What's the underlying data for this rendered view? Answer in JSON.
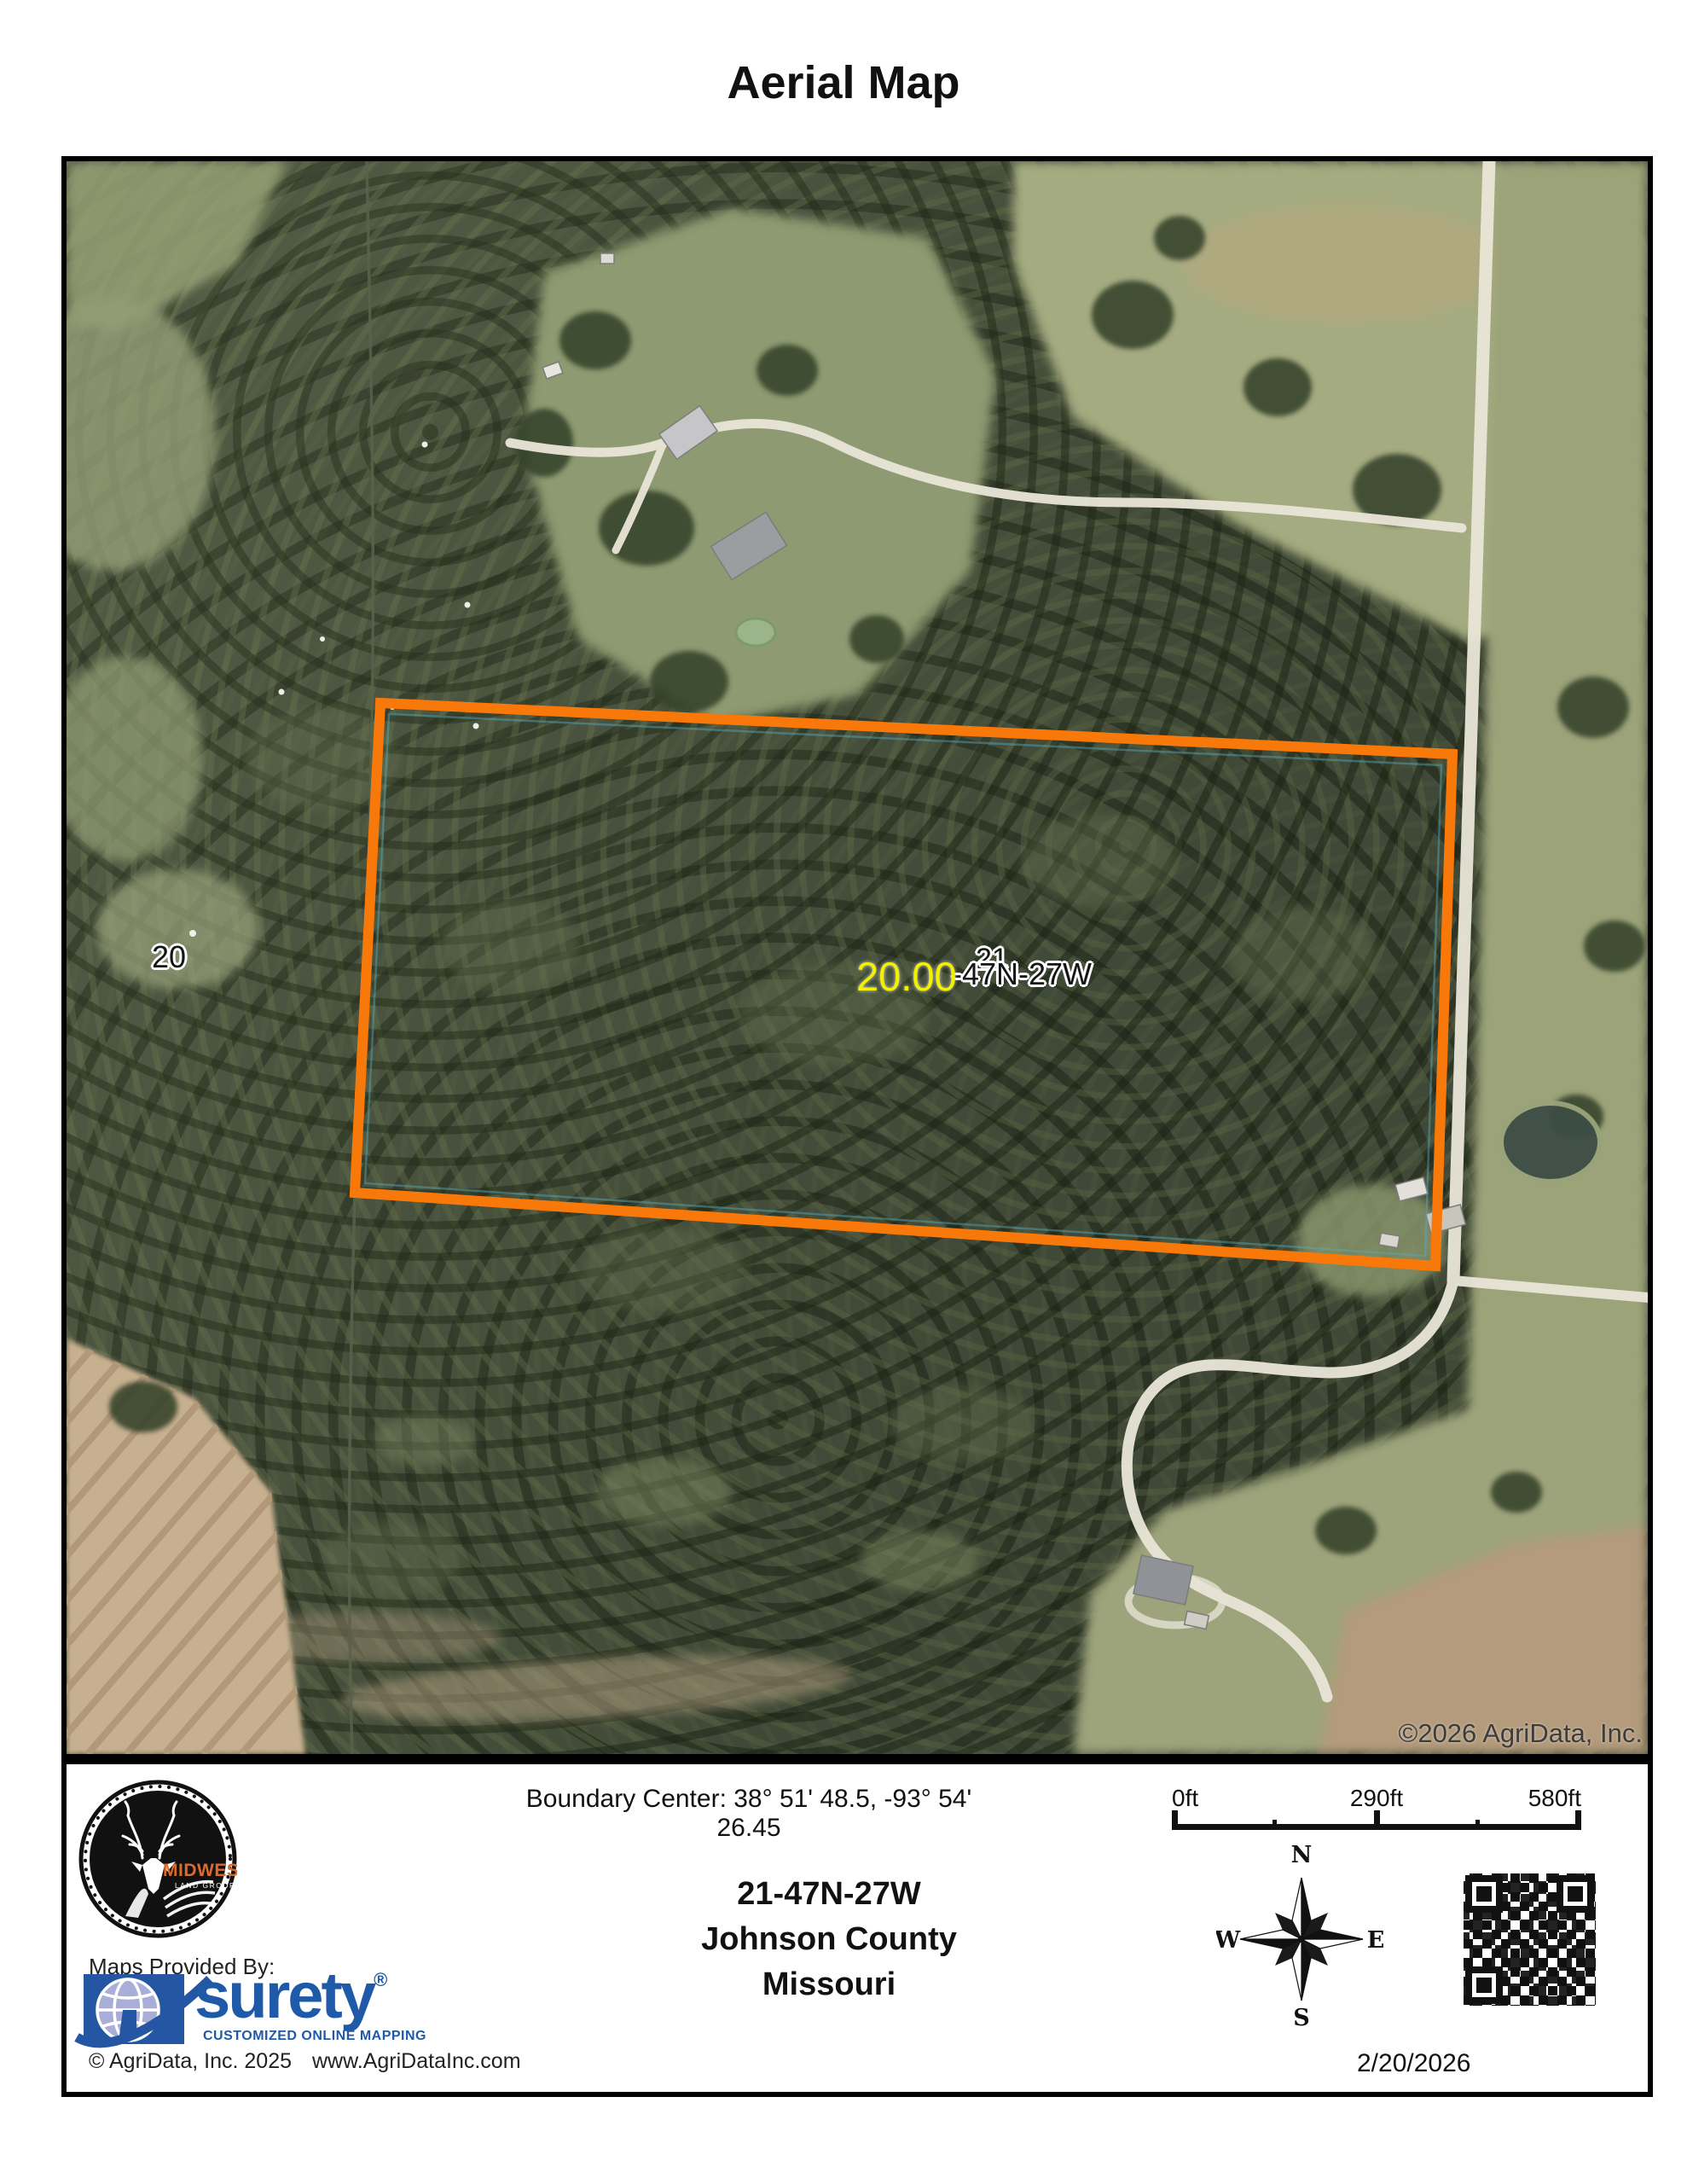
{
  "page": {
    "title": "Aerial Map"
  },
  "map": {
    "boundary_color": "#f8790a",
    "labels": {
      "section_left": "20",
      "section_overlap": "21",
      "acreage": "20.00",
      "trs_fragment": "-47N-27W",
      "imagery_credit": "©2026 AgriData, Inc."
    }
  },
  "footer": {
    "boundary_center": "Boundary Center: 38° 51' 48.5,  -93° 54' 26.45",
    "location": {
      "trs": "21-47N-27W",
      "county": "Johnson County",
      "state": "Missouri"
    },
    "logo": {
      "brand": "Midwest",
      "suffix": "LAND GROUP"
    },
    "provider": {
      "label": "Maps Provided By:",
      "brand": "surety",
      "registered": "®",
      "tagline": "CUSTOMIZED ONLINE MAPPING",
      "copyright": "© AgriData, Inc. 2025",
      "website": "www.AgriDataInc.com"
    },
    "scale": {
      "t0": "0ft",
      "t1": "290ft",
      "t2": "580ft"
    },
    "compass": {
      "n": "N",
      "e": "E",
      "s": "S",
      "w": "W"
    },
    "date": "2/20/2026"
  }
}
